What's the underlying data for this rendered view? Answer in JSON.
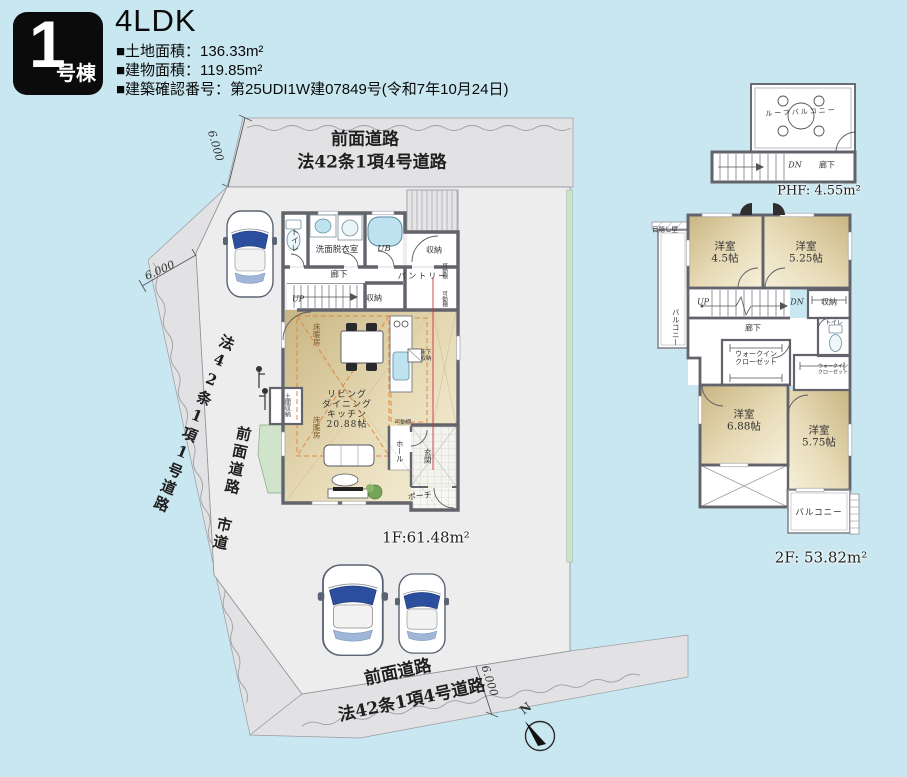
{
  "header": {
    "badge_no": "1",
    "badge_label": "号棟",
    "title": "4LDK",
    "spec1": "■土地面積：136.33m²",
    "spec2": "■建物面積：119.85m²",
    "spec3": "■建築確認番号：第25UDI1W建07849号(令和7年10月24日)"
  },
  "site": {
    "road_top_1": "前面道路",
    "road_top_2": "法42条1項4号道路",
    "road_left_1": "法42条1項1号道路",
    "road_left_2": "前面道路 市道",
    "road_bottom_1": "前面道路",
    "road_bottom_2": "法42条1項4号道路",
    "dim_top": "6.000",
    "dim_left": "6.000",
    "dim_bottom": "6.000",
    "north": "N"
  },
  "f1": {
    "area": "1F:61.48m²",
    "toilet": "トイレ",
    "washroom": "洗面脱衣室",
    "bath": "UB",
    "closet_top": "収納",
    "hallway": "廊下",
    "up": "UP",
    "closet_stairs": "収納",
    "pantry": "パントリー",
    "shelf": "可動棚",
    "heating": "床暖房",
    "ldk": "リビング\nダイニング\nキッチン\n20.88帖",
    "underfloor": "床下\n収納",
    "hall": "ホール",
    "entrance": "玄関",
    "porch": "ポーチ",
    "doma": "土間収納"
  },
  "f2": {
    "area": "2F: 53.82m²",
    "room1": "洋室\n4.5帖",
    "room2": "洋室\n5.25帖",
    "room3": "洋室\n6.88帖",
    "room4": "洋室\n5.75帖",
    "up": "UP",
    "dn": "DN",
    "closet": "収納",
    "hallway": "廊下",
    "toilet": "トイレ",
    "wic": "ウォークイン\nクローゼット",
    "balcony_left": "バルコニー",
    "balcony": "バルコニー",
    "privacy_wall": "目隠し壁"
  },
  "phf": {
    "area": "PHF: 4.55m²",
    "roof_balcony": "ルーフバルコニー",
    "dn": "DN",
    "hallway": "廊下"
  },
  "colors": {
    "background": "#c9e7f1",
    "road_gray": "#e2e2e4",
    "parcel_gray": "#ededee",
    "wall_gray": "#63636b",
    "room_tan": "#d8c69a",
    "fixture_blue": "#bfe3ee",
    "floor_heating_orange": "#e08840",
    "section_line_red": "#d03040",
    "badge_black": "#0b0b0b"
  }
}
